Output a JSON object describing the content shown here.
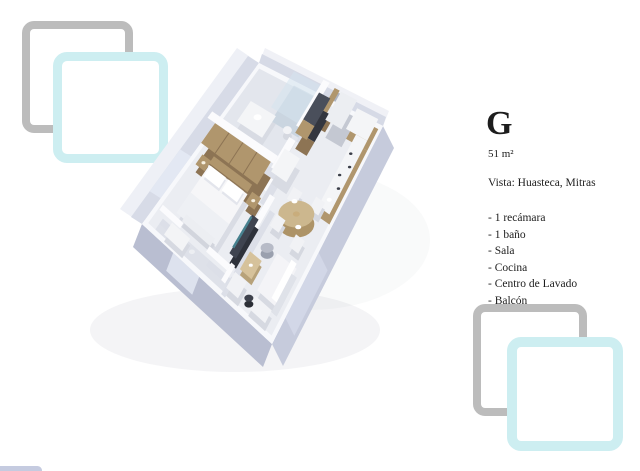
{
  "page": {
    "background": "#ffffff"
  },
  "unit": {
    "letter": "G",
    "area": "51 m²",
    "vista": "Vista: Huasteca, Mitras",
    "features": [
      "- 1 recámara",
      "- 1 baño",
      "- Sala",
      "- Cocina",
      "- Centro de Lavado",
      "- Balcón"
    ]
  },
  "decor": {
    "teal": "#cdeef1",
    "gray": "#bcbcbc",
    "sliver": "#c5cbe0"
  },
  "floorplan": {
    "colors": {
      "floor": "#ebedf2",
      "bath_floor": "#e3e6ed",
      "balcony_floor": "#dee1e9",
      "wall_sw": "#b9bed1",
      "wall_se": "#c6cbdc",
      "wall_inner": "#d7dbe7",
      "wall_top": "#f7f8fb",
      "wood": "#b0966d",
      "wood_dark": "#8d7454",
      "appliance_dark": "#4a4f5b",
      "tv_screen": "#47818f",
      "pouf": "#b7bbc7",
      "table_top": "#ccb78e"
    },
    "corners": {
      "n": [
        259,
        63
      ],
      "e": [
        383,
        126
      ],
      "s": [
        272,
        344
      ],
      "w": [
        142,
        224
      ]
    },
    "items": [
      {
        "k": "ellpx",
        "x": 235,
        "y": 330,
        "rx": 145,
        "ry": 42,
        "f": "#8f94a6",
        "op": 0.1
      },
      {
        "k": "ellpx",
        "x": 310,
        "y": 240,
        "rx": 120,
        "ry": 70,
        "f": "#8f94a6",
        "op": 0.05
      },
      {
        "k": "face",
        "a": [
          100,
          0
        ],
        "b": [
          100,
          100
        ],
        "o": [
          11,
          22
        ],
        "f": "#c6cbdc"
      },
      {
        "k": "face",
        "a": [
          0,
          100
        ],
        "b": [
          100,
          100
        ],
        "o": [
          -9,
          23
        ],
        "f": "#b9bed1"
      },
      {
        "k": "flat",
        "r": [
          0,
          0,
          100,
          100
        ],
        "f": "#ebedf2"
      },
      {
        "k": "flat",
        "r": [
          0,
          0,
          52,
          40
        ],
        "f": "#e3e6ed"
      },
      {
        "k": "flat",
        "r": [
          8,
          91,
          60,
          100
        ],
        "f": "#dee1e9"
      },
      {
        "k": "face",
        "a": [
          0,
          0
        ],
        "b": [
          0,
          100
        ],
        "o": [
          -22,
          -15
        ],
        "f": "#eef0f6"
      },
      {
        "k": "face",
        "a": [
          0,
          0
        ],
        "b": [
          0,
          100
        ],
        "o": [
          -11,
          -7
        ],
        "f": "#d7dbe7"
      },
      {
        "k": "face",
        "a": [
          0,
          58
        ],
        "b": [
          0,
          84
        ],
        "o": [
          -11,
          -7
        ],
        "f": "#e3e8f3"
      },
      {
        "k": "face",
        "a": [
          0,
          0
        ],
        "b": [
          100,
          0
        ],
        "o": [
          6,
          -15
        ],
        "f": "#f0f1f6"
      },
      {
        "k": "face",
        "a": [
          0,
          0
        ],
        "b": [
          100,
          0
        ],
        "o": [
          3,
          -9
        ],
        "f": "#d6dae6"
      },
      {
        "k": "face",
        "a": [
          100,
          58
        ],
        "b": [
          100,
          88
        ],
        "o": [
          9,
          18
        ],
        "f": "#d2d7e7"
      },
      {
        "k": "face",
        "a": [
          24,
          100
        ],
        "b": [
          44,
          100
        ],
        "o": [
          -7,
          18
        ],
        "f": "#dde2ee"
      },
      {
        "k": "flat",
        "r": [
          0,
          0,
          100,
          2.5
        ],
        "f": "#f7f8fb"
      },
      {
        "k": "flat",
        "r": [
          0,
          0,
          2.5,
          100
        ],
        "f": "#f7f8fb"
      },
      {
        "k": "flat",
        "r": [
          97.5,
          0,
          100,
          100
        ],
        "f": "#f7f8fb"
      },
      {
        "k": "flat",
        "r": [
          0,
          97.5,
          100,
          100
        ],
        "f": "#f7f8fb"
      },
      {
        "k": "face",
        "a": [
          58,
          0
        ],
        "b": [
          67,
          0
        ],
        "o": [
          3,
          -9
        ],
        "f": "#7d8292",
        "op": 0.45
      },
      {
        "k": "box",
        "r": [
          30,
          2,
          52,
          22
        ],
        "f": "rgba(213,227,238,0.55)",
        "s": "rgba(183,199,214,0.55)",
        "h": 14
      },
      {
        "k": "box",
        "r": [
          52,
          0,
          57,
          24
        ],
        "f": "#fbfbfd",
        "s": "#dcdfe8",
        "h": 16
      },
      {
        "k": "box",
        "r": [
          14,
          22,
          34,
          34
        ],
        "f": "#f4f5f7",
        "s": "#d8dbe3",
        "h": 8
      },
      {
        "k": "circ",
        "c": [
          24,
          27
        ],
        "rx": 4,
        "ry": 3,
        "f": "#ffffff",
        "dz": 8
      },
      {
        "k": "circ",
        "c": [
          45,
          24
        ],
        "rx": 4.5,
        "ry": 4,
        "f": "#f2f3f6",
        "s": "#d5d8e0",
        "h": 6
      },
      {
        "k": "box",
        "r": [
          62,
          1,
          66,
          14
        ],
        "f": "#b0966d",
        "s": "#8d7454",
        "h": 16
      },
      {
        "k": "box",
        "r": [
          54,
          6,
          63,
          20
        ],
        "f": "#4a4f5b",
        "s": "#33363f",
        "h": 16
      },
      {
        "k": "box",
        "r": [
          54,
          20,
          63,
          27
        ],
        "f": "#b0966d",
        "s": "#8d7454",
        "h": 16
      },
      {
        "k": "box",
        "r": [
          68,
          2,
          81,
          16
        ],
        "f": "#eceef2",
        "s": "#c4c8d2",
        "h": 18
      },
      {
        "k": "box",
        "r": [
          81,
          2,
          98,
          12
        ],
        "f": "#f4f5f7",
        "s": "#b0966d",
        "h": 10
      },
      {
        "k": "box",
        "r": [
          52,
          30,
          57,
          56
        ],
        "f": "#fbfbfd",
        "s": "#dcdfe8",
        "h": 16
      },
      {
        "k": "box",
        "r": [
          0,
          40,
          52,
          44
        ],
        "f": "#fbfbfd",
        "s": "#dcdfe8",
        "h": 16
      },
      {
        "k": "box",
        "r": [
          6,
          44,
          50,
          56
        ],
        "f": "#b0966d",
        "s": "#8d7454",
        "h": 16
      },
      {
        "k": "line",
        "a": [
          17,
          44
        ],
        "b": [
          17,
          56
        ],
        "f": "#8d7454",
        "w": 1,
        "dz": 16
      },
      {
        "k": "line",
        "a": [
          28,
          44
        ],
        "b": [
          28,
          56
        ],
        "f": "#8d7454",
        "w": 1,
        "dz": 16
      },
      {
        "k": "line",
        "a": [
          39,
          44
        ],
        "b": [
          39,
          56
        ],
        "f": "#8d7454",
        "w": 1,
        "dz": 16
      },
      {
        "k": "box",
        "r": [
          52,
          34,
          64,
          46
        ],
        "f": "#f4f5f7",
        "s": "#d8dbe3",
        "h": 12
      },
      {
        "k": "box",
        "r": [
          89,
          12,
          98,
          46
        ],
        "f": "#f4f5f7",
        "s": "#b0966d",
        "h": 10
      },
      {
        "k": "circ",
        "c": [
          92,
          20
        ],
        "rx": 1.7,
        "ry": 1.3,
        "f": "#3a3e48",
        "dz": 10
      },
      {
        "k": "circ",
        "c": [
          95.5,
          25
        ],
        "rx": 1.7,
        "ry": 1.3,
        "f": "#3a3e48",
        "dz": 10
      },
      {
        "k": "circ",
        "c": [
          92,
          30
        ],
        "rx": 1.7,
        "ry": 1.3,
        "f": "#3a3e48",
        "dz": 10
      },
      {
        "k": "circ",
        "c": [
          95.5,
          35
        ],
        "rx": 1.7,
        "ry": 1.3,
        "f": "#3a3e48",
        "dz": 10
      },
      {
        "k": "circ",
        "c": [
          93.5,
          41
        ],
        "rx": 2.5,
        "ry": 2,
        "f": "#ffffff",
        "dz": 10
      },
      {
        "k": "box",
        "r": [
          16,
          56,
          46,
          60
        ],
        "f": "#b0966d",
        "s": "#8d7454",
        "h": 12
      },
      {
        "k": "box",
        "r": [
          8,
          57,
          15,
          63
        ],
        "f": "#b0966d",
        "s": "#8d7454",
        "h": 8
      },
      {
        "k": "box",
        "r": [
          47,
          57,
          54,
          63
        ],
        "f": "#b0966d",
        "s": "#8d7454",
        "h": 8
      },
      {
        "k": "circ",
        "c": [
          11.5,
          60
        ],
        "rx": 2,
        "ry": 1.6,
        "f": "#f6efdf",
        "dz": 8
      },
      {
        "k": "circ",
        "c": [
          50.5,
          60
        ],
        "rx": 2,
        "ry": 1.6,
        "f": "#f6efdf",
        "dz": 8
      },
      {
        "k": "box",
        "r": [
          68,
          44,
          75,
          50
        ],
        "f": "#f1f2f5",
        "s": "#d5d8e0",
        "h": 7
      },
      {
        "k": "box",
        "r": [
          84,
          42,
          91,
          48
        ],
        "f": "#f1f2f5",
        "s": "#d5d8e0",
        "h": 7
      },
      {
        "k": "box",
        "r": [
          16,
          60,
          46,
          88
        ],
        "f": "#f6f6f8",
        "s": "#d9dce4",
        "h": 10
      },
      {
        "k": "box",
        "r": [
          18,
          61,
          30,
          67
        ],
        "f": "#ffffff",
        "s": "#e3e5ec",
        "h": 3,
        "dz": 10
      },
      {
        "k": "box",
        "r": [
          32,
          61,
          44,
          67
        ],
        "f": "#ffffff",
        "s": "#e3e5ec",
        "h": 3,
        "dz": 10
      },
      {
        "k": "flat",
        "r": [
          16,
          76,
          46,
          88
        ],
        "f": "#eef0f4",
        "dz": 10
      },
      {
        "k": "circ",
        "c": [
          79,
          54
        ],
        "rx": 18,
        "ry": 13.5,
        "f": "#ccb78e",
        "s": "#ad9367",
        "h": 10
      },
      {
        "k": "circ",
        "c": [
          74,
          50
        ],
        "rx": 3,
        "ry": 2.2,
        "f": "#ffffff",
        "dz": 10
      },
      {
        "k": "circ",
        "c": [
          84,
          58
        ],
        "rx": 3,
        "ry": 2.2,
        "f": "#ffffff",
        "dz": 10
      },
      {
        "k": "circ",
        "c": [
          79,
          54
        ],
        "rx": 3.5,
        "ry": 2.6,
        "f": "#c9ad7c",
        "dz": 10
      },
      {
        "k": "box",
        "r": [
          67,
          58,
          74,
          64
        ],
        "f": "#f1f2f5",
        "s": "#d5d8e0",
        "h": 7
      },
      {
        "k": "box",
        "r": [
          84,
          60,
          91,
          66
        ],
        "f": "#f1f2f5",
        "s": "#d5d8e0",
        "h": 7
      },
      {
        "k": "box",
        "r": [
          60,
          56,
          64,
          88
        ],
        "f": "#fbfbfd",
        "s": "#dcdfe8",
        "h": 16
      },
      {
        "k": "box",
        "r": [
          20,
          84,
          42,
          88
        ],
        "f": "#eceef2",
        "s": "#d2d5dd",
        "h": 6
      },
      {
        "k": "box",
        "r": [
          8,
          91,
          24,
          94
        ],
        "f": "#fbfbfd",
        "s": "#dcdfe8",
        "h": 14
      },
      {
        "k": "box",
        "r": [
          44,
          91,
          60,
          94
        ],
        "f": "#fbfbfd",
        "s": "#dcdfe8",
        "h": 14
      },
      {
        "k": "box",
        "r": [
          55,
          66,
          60,
          86
        ],
        "f": "#3f4450",
        "s": "#2e323b",
        "h": 10
      },
      {
        "k": "flat",
        "r": [
          55.5,
          68,
          57,
          84
        ],
        "f": "#47818f",
        "dz": 13
      },
      {
        "k": "circ",
        "c": [
          72,
          72
        ],
        "rx": 6.5,
        "ry": 5,
        "f": "#b7bbc7",
        "s": "#9aa0ae",
        "h": 6
      },
      {
        "k": "box",
        "r": [
          64,
          78,
          73,
          87
        ],
        "f": "#d6c29b",
        "s": "#b7a27a",
        "h": 6
      },
      {
        "k": "circ",
        "c": [
          68.5,
          82.5
        ],
        "rx": 2,
        "ry": 1.6,
        "f": "#ffffff",
        "dz": 6
      },
      {
        "k": "box",
        "r": [
          16,
          92,
          30,
          99
        ],
        "f": "#f3f4f6",
        "s": "#d6d9e1",
        "h": 7
      },
      {
        "k": "circ",
        "c": [
          34,
          95
        ],
        "rx": 3,
        "ry": 2.3,
        "f": "#eceef2",
        "dz": 4
      },
      {
        "k": "box",
        "r": [
          60,
          90,
          63,
          99
        ],
        "f": "#fbfbfd",
        "s": "#dcdfe8",
        "h": 14
      },
      {
        "k": "box",
        "r": [
          63,
          90,
          72,
          98
        ],
        "f": "#f1f2f5",
        "s": "#d5d8e0",
        "h": 8
      },
      {
        "k": "box",
        "r": [
          80,
          72,
          95,
          90
        ],
        "f": "#f4f4f7",
        "s": "#d7dae2",
        "h": 9
      },
      {
        "k": "box",
        "r": [
          91,
          72,
          95,
          90
        ],
        "f": "#ffffff",
        "s": "#dfe2e9",
        "h": 14
      },
      {
        "k": "box",
        "r": [
          80,
          92,
          93,
          98
        ],
        "f": "#f2f3f6",
        "s": "#d6d9e1",
        "h": 8
      },
      {
        "k": "circ",
        "c": [
          77,
          94
        ],
        "rx": 4.5,
        "ry": 3.5,
        "f": "#3d414c",
        "s": "#2b2e36",
        "h": 6
      }
    ]
  }
}
